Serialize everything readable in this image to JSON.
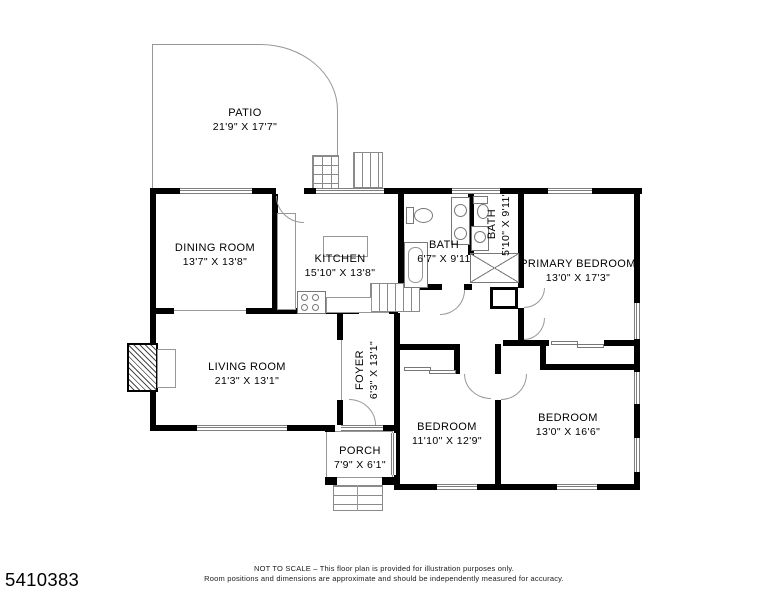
{
  "plan": {
    "rooms": {
      "patio": {
        "name": "PATIO",
        "dims": "21'9\" X 17'7\""
      },
      "dining": {
        "name": "DINING ROOM",
        "dims": "13'7\" X 13'8\""
      },
      "kitchen": {
        "name": "KITCHEN",
        "dims": "15'10\" X 13'8\""
      },
      "bath1": {
        "name": "BATH",
        "dims": "6'7\" X 9'11"
      },
      "bath2": {
        "name": "BATH",
        "dims": "5'10\" X 9'11\""
      },
      "primary": {
        "name": "PRIMARY BEDROOM",
        "dims": "13'0\" X 17'3\""
      },
      "living": {
        "name": "LIVING ROOM",
        "dims": "21'3\" X 13'1\""
      },
      "foyer": {
        "name": "FOYER",
        "dims": "6'3\" X 13'1\""
      },
      "bedroom1": {
        "name": "BEDROOM",
        "dims": "11'10\" X 12'9\""
      },
      "bedroom2": {
        "name": "BEDROOM",
        "dims": "13'0\" X 16'6\""
      },
      "porch": {
        "name": "PORCH",
        "dims": "7'9\" X 6'1\""
      }
    },
    "footer": {
      "listing_id": "5410383",
      "disclaimer_line1": "NOT TO SCALE – This floor plan is provided for illustration purposes only.",
      "disclaimer_line2": "Room positions and dimensions are approximate and should be independently measured for accuracy."
    },
    "colors": {
      "wall": "#000000",
      "thin_line": "#979797",
      "background": "#ffffff"
    }
  }
}
